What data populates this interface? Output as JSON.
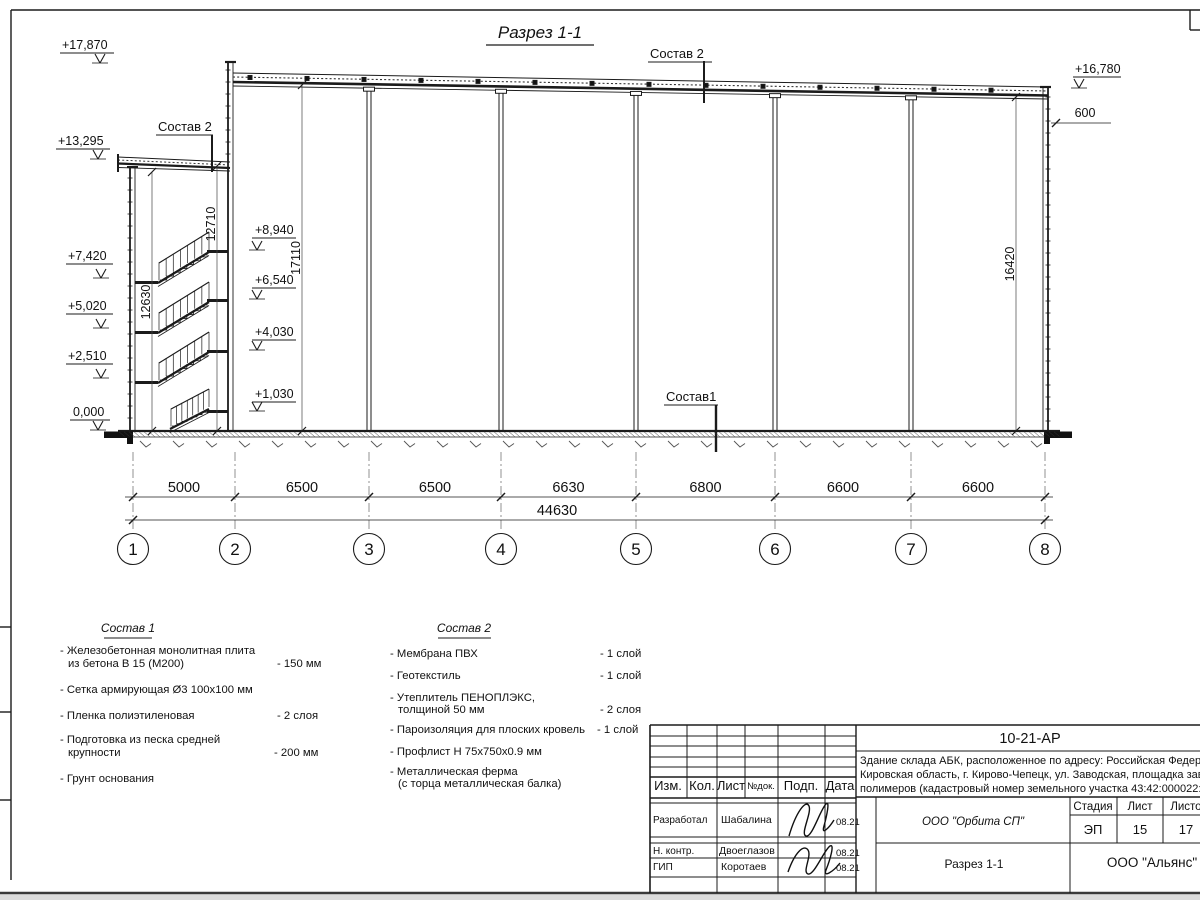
{
  "title": "Разрез 1-1",
  "callouts": {
    "sostav2_top": "Состав 2",
    "sostav2_left": "Состав 2",
    "sostav1": "Состав1"
  },
  "elev": [
    "+17,870",
    "+13,295",
    "+7,420",
    "+5,020",
    "+2,510",
    "0,000",
    "+8,940",
    "+6,540",
    "+4,030",
    "+1,030",
    "+16,780"
  ],
  "vdims": [
    "12630",
    "12710",
    "17110",
    "16420"
  ],
  "parapet_offset": "600",
  "grid": {
    "axes": [
      "1",
      "2",
      "3",
      "4",
      "5",
      "6",
      "7",
      "8"
    ],
    "spans": [
      "5000",
      "6500",
      "6500",
      "6630",
      "6800",
      "6600",
      "6600"
    ],
    "total": "44630"
  },
  "sostav1": {
    "header": "Состав 1",
    "lines": [
      {
        "t": "- Железобетонная  монолитная плита",
        "v": ""
      },
      {
        "t": "из бетона В 15 (М200)",
        "v": "- 150 мм"
      },
      {
        "t": "- Сетка армирующая Ø3 100х100 мм",
        "v": ""
      },
      {
        "t": "- Пленка полиэтиленовая",
        "v": "-  2 слоя"
      },
      {
        "t": "- Подготовка из песка средней",
        "v": ""
      },
      {
        "t": "крупности",
        "v": "- 200 мм"
      },
      {
        "t": "- Грунт основания",
        "v": ""
      }
    ]
  },
  "sostav2": {
    "header": "Состав 2",
    "lines": [
      {
        "t": "- Мембрана ПВХ",
        "v": "- 1 слой"
      },
      {
        "t": "- Геотекстиль",
        "v": "- 1 слой"
      },
      {
        "t": "- Утеплитель ПЕНОПЛЭКС,",
        "v": ""
      },
      {
        "t": "толщиной 50 мм",
        "v": "- 2 слоя"
      },
      {
        "t": "- Пароизоляция для плоских кровель",
        "v": "- 1 слой"
      },
      {
        "t": "- Профлист Н 75х750х0.9 мм",
        "v": ""
      },
      {
        "t": "- Металлическая ферма",
        "v": ""
      },
      {
        "t": "(с торца металлическая балка)",
        "v": ""
      }
    ]
  },
  "titleblock": {
    "doc_code": "10-21-АР",
    "desc1": "Здание склада АБК, расположенное по адресу: Российская Федера",
    "desc2": "Кировская область, г. Кирово-Чепецк, ул. Заводская, площадка заво",
    "desc3": "полимеров (кадастровый номер земельного участка 43:42:000022:3",
    "cols": [
      "Изм.",
      "Кол.",
      "Лист",
      "№док.",
      "Подп.",
      "Дата"
    ],
    "rows": [
      {
        "role": "Разработал",
        "name": "Шабалина",
        "date": "08.21"
      },
      {
        "role": "Н. контр.",
        "name": "Двоеглазов",
        "date": "08.21"
      },
      {
        "role": "ГИП",
        "name": "Коротаев",
        "date": "08.21"
      }
    ],
    "stage_label": "Стадия",
    "sheet_label": "Лист",
    "sheets_label": "Листов",
    "stage": "ЭП",
    "sheet_num": "15",
    "sheets_total": "17",
    "org": "ООО \"Орбита СП\"",
    "drawing_name": "Разрез 1-1",
    "contractor": "ООО \"Альянс\""
  }
}
